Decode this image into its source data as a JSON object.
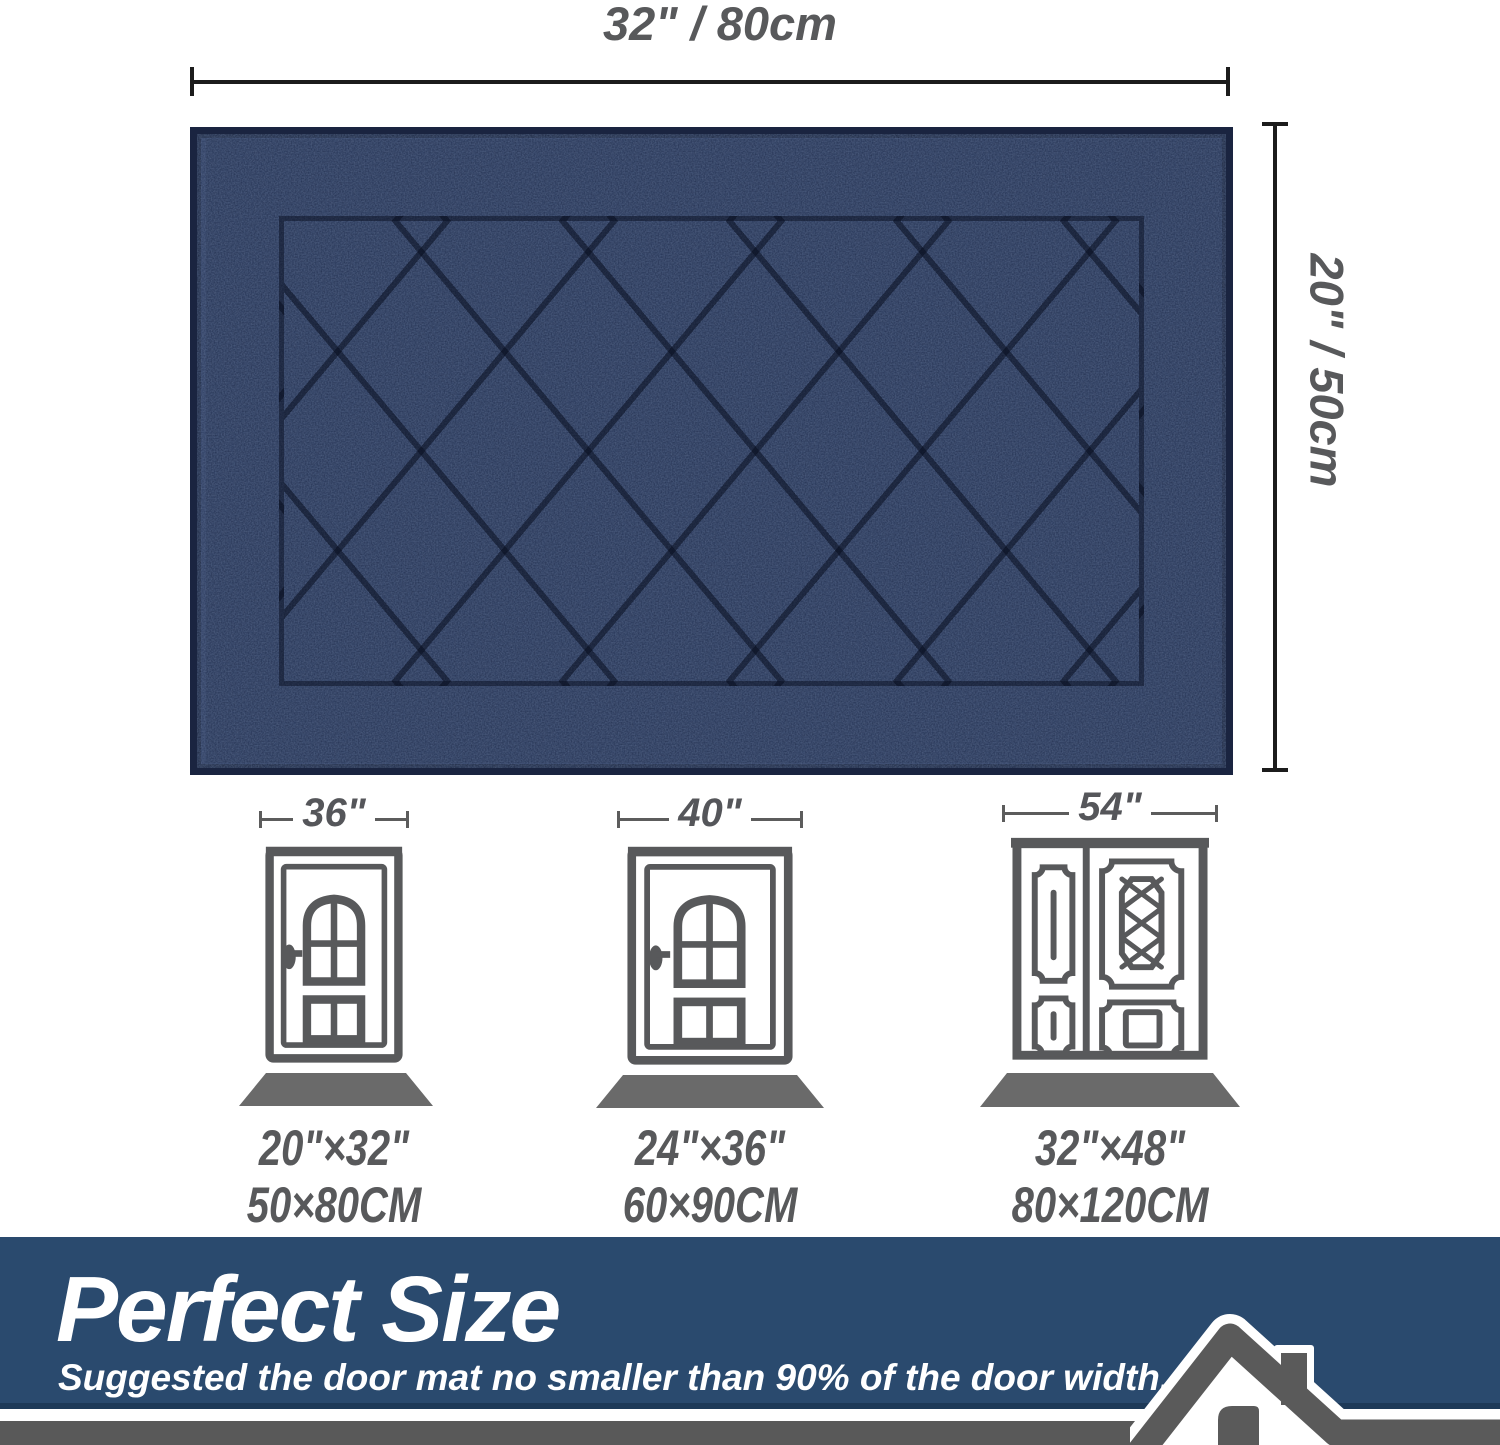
{
  "top_dimension": {
    "label": "32\" / 80cm"
  },
  "side_dimension": {
    "label": "20\" / 50cm"
  },
  "mat": {
    "description": "navy blue diamond-pattern door mat",
    "color": "#1f2b4a"
  },
  "doors": [
    {
      "width_label": "36\"",
      "size_label_inches": "20\"×32\"",
      "size_label_cm": "50×80CM"
    },
    {
      "width_label": "40\"",
      "size_label_inches": "24\"×36\"",
      "size_label_cm": "60×90CM"
    },
    {
      "width_label": "54\"",
      "size_label_inches": "32\"×48\"",
      "size_label_cm": "80×120CM"
    }
  ],
  "banner": {
    "title": "Perfect Size",
    "subtitle": "Suggested the door mat no smaller than 90% of the door width."
  },
  "colors": {
    "banner_blue": "#2a4a6e",
    "mat_navy": "#1f2b4a",
    "dimension_text_gray": "#58595b",
    "door_line_gray": "#58595b",
    "bottom_strip_gray": "#595959"
  }
}
